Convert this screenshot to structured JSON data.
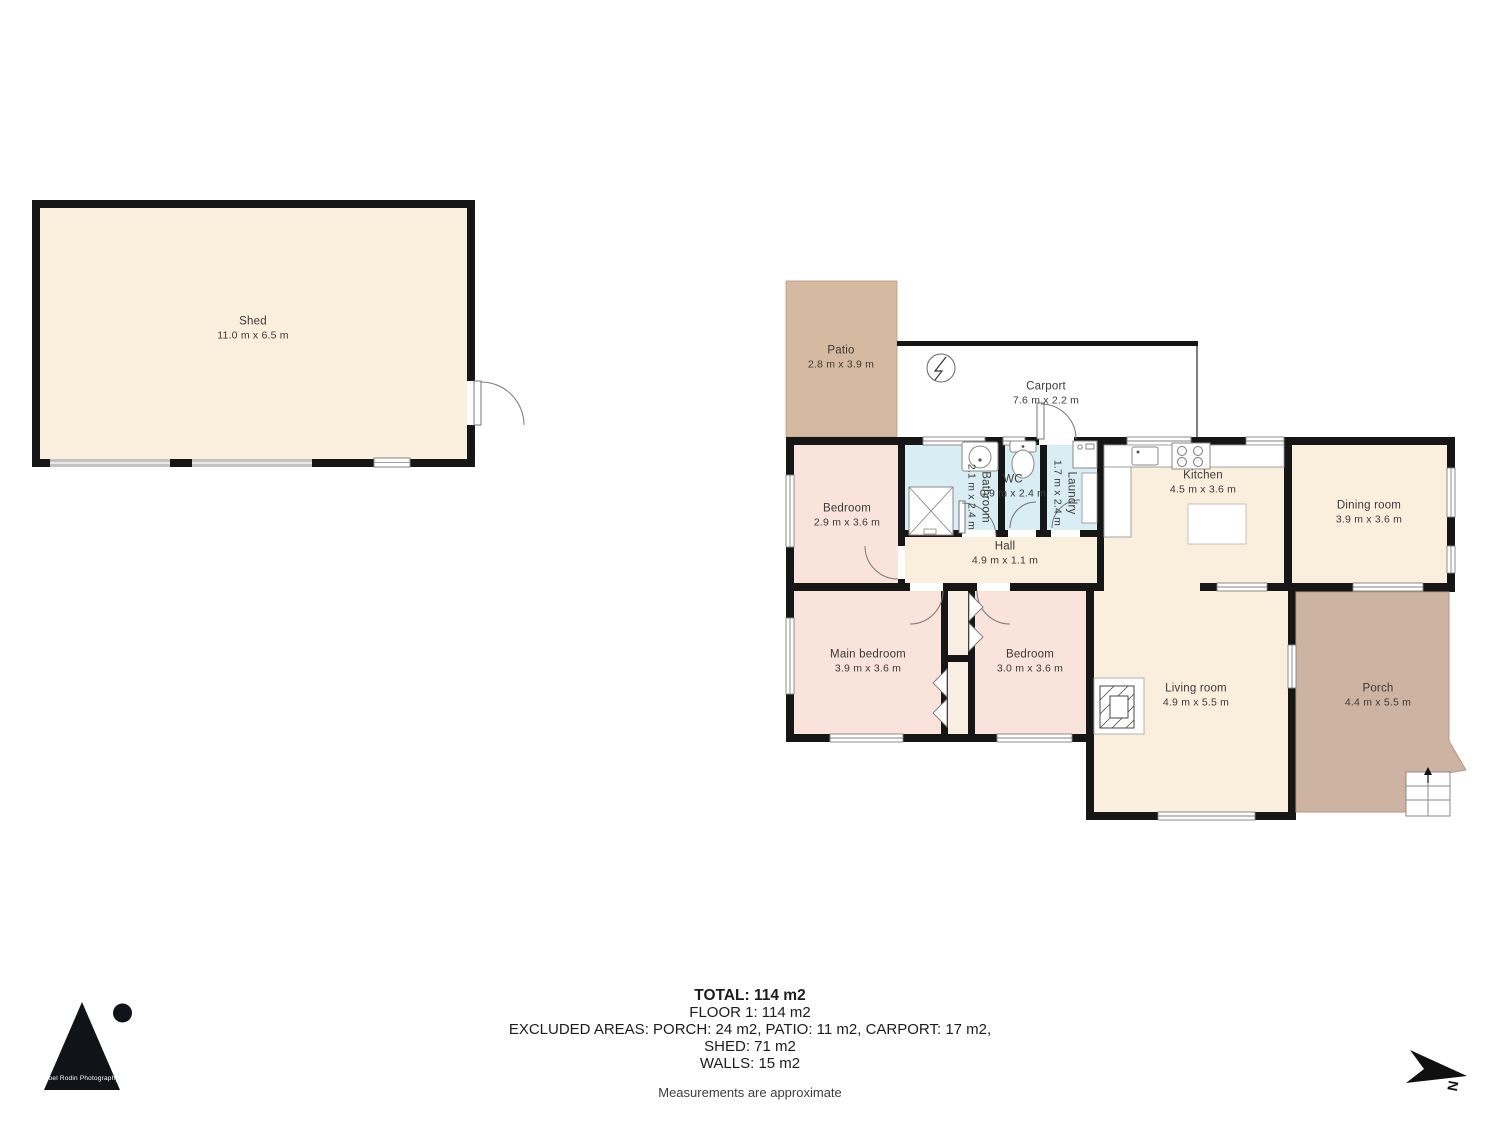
{
  "rooms": [
    {
      "id": "shed",
      "name": "Shed",
      "dims": "11.0 m x 6.5 m"
    },
    {
      "id": "patio",
      "name": "Patio",
      "dims": "2.8 m x 3.9 m"
    },
    {
      "id": "carport",
      "name": "Carport",
      "dims": "7.6 m x 2.2 m"
    },
    {
      "id": "bedroom-top",
      "name": "Bedroom",
      "dims": "2.9 m x 3.6 m"
    },
    {
      "id": "bathroom",
      "name": "Bathroom",
      "dims": "2.1 m x 2.4 m"
    },
    {
      "id": "wc",
      "name": "WC",
      "dims": "0.9 m x 2.4 m"
    },
    {
      "id": "laundry",
      "name": "Laundry",
      "dims": "1.7 m x 2.4 m"
    },
    {
      "id": "kitchen",
      "name": "Kitchen",
      "dims": "4.5 m x 3.6 m"
    },
    {
      "id": "dining",
      "name": "Dining room",
      "dims": "3.9 m x 3.6 m"
    },
    {
      "id": "hall",
      "name": "Hall",
      "dims": "4.9 m x 1.1 m"
    },
    {
      "id": "main-bedroom",
      "name": "Main bedroom",
      "dims": "3.9 m x 3.6 m"
    },
    {
      "id": "bedroom-2",
      "name": "Bedroom",
      "dims": "3.0 m x 3.6 m"
    },
    {
      "id": "living",
      "name": "Living room",
      "dims": "4.9 m x 5.5 m"
    },
    {
      "id": "porch",
      "name": "Porch",
      "dims": "4.4 m x 5.5 m"
    }
  ],
  "summary": {
    "total": "TOTAL: 114 m2",
    "floor": "FLOOR 1: 114 m2",
    "excluded": "EXCLUDED AREAS: PORCH: 24 m2, PATIO: 11 m2, CARPORT: 17 m2,",
    "shed": "SHED: 71 m2",
    "walls": "WALLS: 15 m2",
    "note": "Measurements are approximate"
  },
  "logo": {
    "text": "Joel Rodin Photography"
  },
  "compass": {
    "label": "N"
  },
  "colors": {
    "floor_cream": "#faeedd",
    "bedroom_pink": "#fae3da",
    "wet_room_blue": "#d9edf4",
    "patio_tan": "#d5b9a1",
    "porch_tan": "#cdb3a2",
    "wall_black": "#161616",
    "window_gray": "#c2c2c2"
  }
}
